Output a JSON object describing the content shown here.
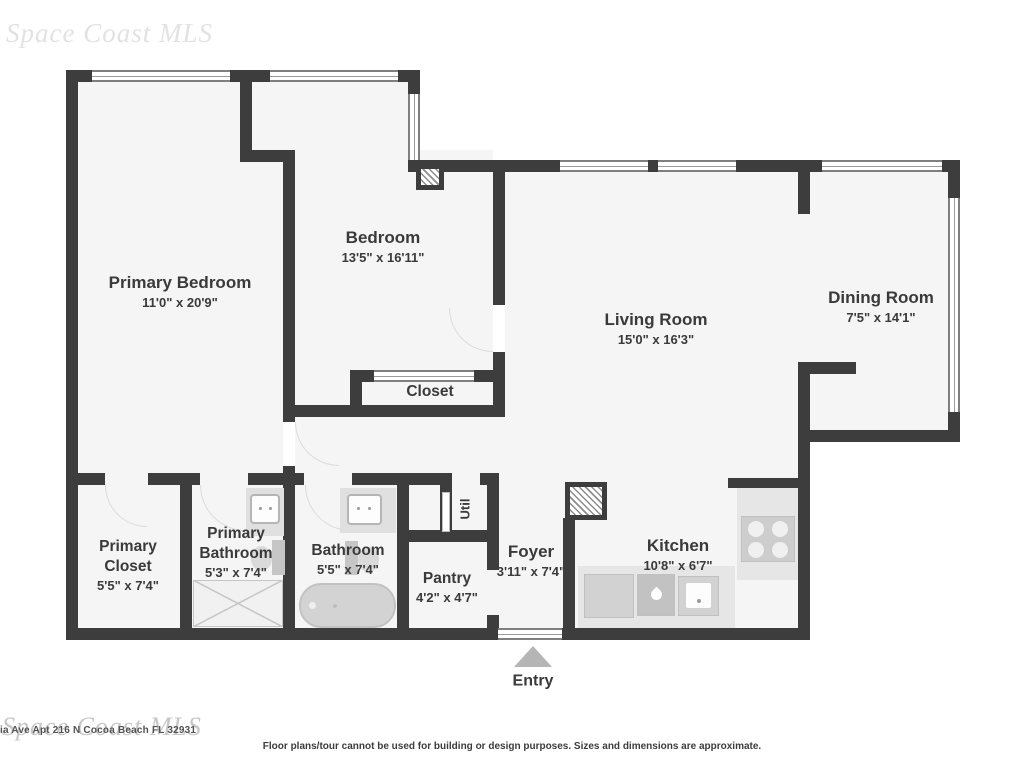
{
  "watermark": {
    "top": "Space Coast MLS",
    "bottom": "Space Coast MLS"
  },
  "footer": {
    "address": "ia Ave Apt 216 N Cocoa Beach FL 32931",
    "disclaimer": "Floor plans/tour cannot be used for building or design purposes. Sizes and dimensions are approximate."
  },
  "rooms": [
    {
      "id": "primary-bedroom",
      "name": "Primary Bedroom",
      "dims": "11'0\" x 20'9\""
    },
    {
      "id": "bedroom",
      "name": "Bedroom",
      "dims": "13'5\" x 16'11\""
    },
    {
      "id": "living-room",
      "name": "Living Room",
      "dims": "15'0\" x 16'3\""
    },
    {
      "id": "dining-room",
      "name": "Dining Room",
      "dims": "7'5\" x 14'1\""
    },
    {
      "id": "closet",
      "name": "Closet",
      "dims": ""
    },
    {
      "id": "primary-closet",
      "name": "Primary Closet",
      "dims": "5'5\" x 7'4\""
    },
    {
      "id": "primary-bathroom",
      "name": "Primary Bathroom",
      "dims": "5'3\" x 7'4\""
    },
    {
      "id": "bathroom",
      "name": "Bathroom",
      "dims": "5'5\" x 7'4\""
    },
    {
      "id": "pantry",
      "name": "Pantry",
      "dims": "4'2\" x 4'7\""
    },
    {
      "id": "foyer",
      "name": "Foyer",
      "dims": "3'11\" x 7'4\""
    },
    {
      "id": "kitchen",
      "name": "Kitchen",
      "dims": "10'8\" x 6'7\""
    },
    {
      "id": "util",
      "name": "Util",
      "dims": ""
    },
    {
      "id": "entry",
      "name": "Entry",
      "dims": ""
    }
  ],
  "icons": {
    "entry-arrow-icon": "up-triangle",
    "column-hatch-icon": "diagonal-hatch-square",
    "vent-hatch-icon": "diagonal-hatch-square",
    "stove-burners-icon": "four-circles",
    "kitchen-sink-icon": "water-drop",
    "shower-icon": "x-crossed-rectangle",
    "bathtub-icon": "rounded-tub",
    "toilet-icon": "tank-and-bowl",
    "vanity-sink-icon": "square-basin"
  },
  "colors": {
    "wall": "#3d3d3d",
    "floor": "#f5f5f5",
    "counter": "#e6e6e6",
    "fixture": "#d2d2d2",
    "label_text": "#3a3a3a",
    "entry_arrow": "#b5b5b5",
    "watermark": "#bdbdbd"
  }
}
